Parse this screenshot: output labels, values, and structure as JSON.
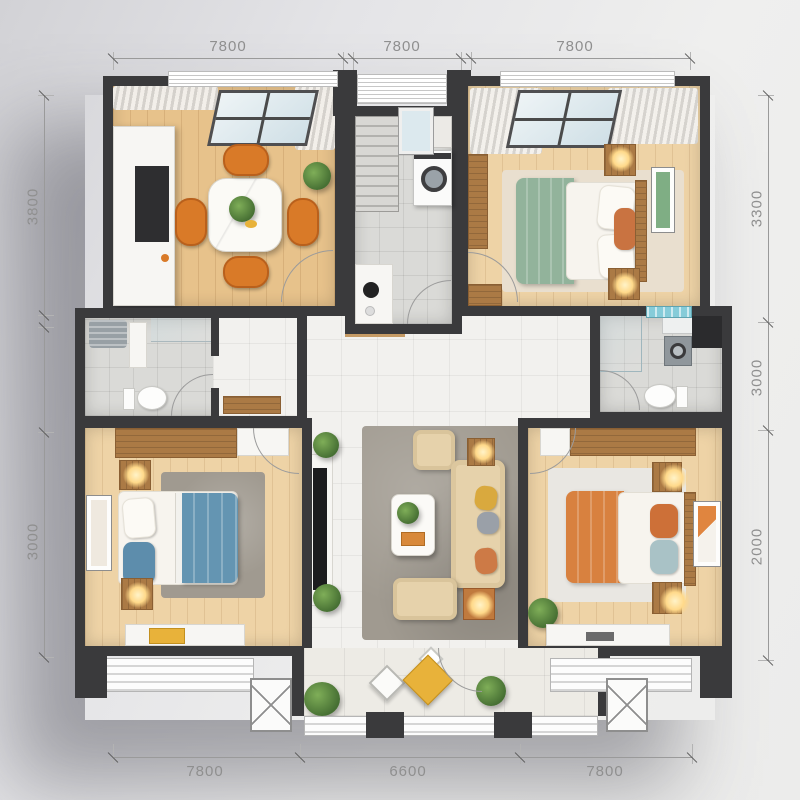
{
  "type": "apartment-floor-plan-render",
  "dimensions": {
    "top": [
      "7800",
      "7800",
      "7800"
    ],
    "bottom": [
      "7800",
      "6600",
      "7800"
    ],
    "left": [
      "3800",
      "3000"
    ],
    "right": [
      "3300",
      "3000",
      "2000"
    ]
  },
  "palette": {
    "wall": "#3a3a3c",
    "wood_floor": "#e7c28b",
    "wood_furniture": "#ab7a45",
    "tile": "#dadad7",
    "marble": "#f2f1ee",
    "green_duvet": "#92b39b",
    "blue_duvet": "#6495b2",
    "orange_duvet": "#d8813f",
    "orange_chair": "#d97a28",
    "sofa_beige": "#e6d2ab",
    "rug_gray": "#a09a90",
    "lamp_glow": "#ffd98a",
    "plant_green": "#527a3a",
    "accent_yellow": "#e8b23a",
    "window_glass": "#dce9ee"
  },
  "rooms": [
    {
      "name": "dining-room",
      "position": "top-left",
      "features": [
        "window-with-blinds",
        "sheer-curtains",
        "skylight",
        "white-sideboard",
        "marble-dining-table",
        "table-plant",
        "four-orange-chairs",
        "corner-plant",
        "oak-floor",
        "door-arc"
      ]
    },
    {
      "name": "laundry-stair-hall",
      "position": "top-center",
      "features": [
        "staircase",
        "window",
        "washing-machine",
        "counter-with-kettle",
        "tile-floor",
        "door-arc"
      ]
    },
    {
      "name": "bedroom-green",
      "position": "top-right",
      "features": [
        "window-with-blinds",
        "skylight",
        "curtains",
        "wardrobe",
        "green-duvet-bed",
        "white-pillows",
        "orange-accent-pillow",
        "two-nightstands-with-lamps",
        "wall-art",
        "beige-rug",
        "door-arc"
      ]
    },
    {
      "name": "bathroom-left",
      "position": "middle-left",
      "features": [
        "ac-unit",
        "shelf",
        "shower-glass",
        "toilet",
        "entry-nook-with-cabinet",
        "tile-floor",
        "door-arc"
      ]
    },
    {
      "name": "bathroom-right",
      "position": "middle-right",
      "features": [
        "teal-window",
        "storage-box",
        "dryer",
        "toilet",
        "shower-glass",
        "tile-floor",
        "door-arc"
      ]
    },
    {
      "name": "bedroom-blue",
      "position": "bottom-left",
      "features": [
        "long-desk",
        "white-cabinet",
        "blue-duvet-bed",
        "white-and-blue-pillows",
        "two-nightstands-with-lamps",
        "wall-art",
        "gray-rug",
        "window-bench-with-yellow-mat",
        "door-arc"
      ]
    },
    {
      "name": "living-room",
      "position": "center",
      "features": [
        "marble-floor",
        "gray-rug",
        "tv-console",
        "tv",
        "armchair",
        "three-seat-sofa",
        "yellow-gray-orange-pillows",
        "loveseat",
        "coffee-table-with-plant-and-tray",
        "two-side-tables-with-lamps",
        "two-plants"
      ]
    },
    {
      "name": "bedroom-orange",
      "position": "bottom-right",
      "features": [
        "wardrobe",
        "white-cabinet",
        "orange-duvet-bed",
        "orange-and-blue-pillows",
        "two-nightstands-with-lamps",
        "wall-art",
        "light-rug",
        "plant",
        "window-bench",
        "door-arc"
      ]
    },
    {
      "name": "balcony",
      "position": "bottom-center",
      "features": [
        "tile-floor",
        "two-plants",
        "yellow-pouf",
        "white-trays",
        "window-band",
        "door-arc"
      ]
    },
    {
      "name": "side-balconies",
      "position": "bottom-left-and-right",
      "features": [
        "window-sill",
        "x-pattern-window"
      ]
    }
  ]
}
